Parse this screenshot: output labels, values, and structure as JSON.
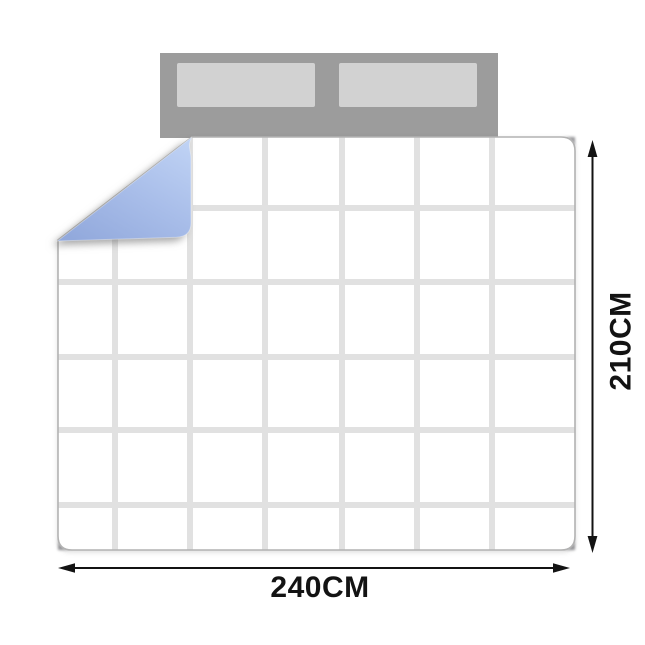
{
  "figure": {
    "width_label": "240CM",
    "height_label": "210CM"
  },
  "colors": {
    "background": "#ffffff",
    "headboard_gray": "#9c9c9c",
    "pillow_gray": "#d2d2d2",
    "quilt_face": "#ffffff",
    "quilt_seam": "#e1e1e1",
    "quilt_outline": "#b2b2b2",
    "fold_blue_light": "#bfd2f4",
    "fold_blue_mid": "#a8bde9",
    "fold_blue_dark": "#92a9dc",
    "corner_shadow": "#98989b",
    "dimension_color": "#131313"
  }
}
